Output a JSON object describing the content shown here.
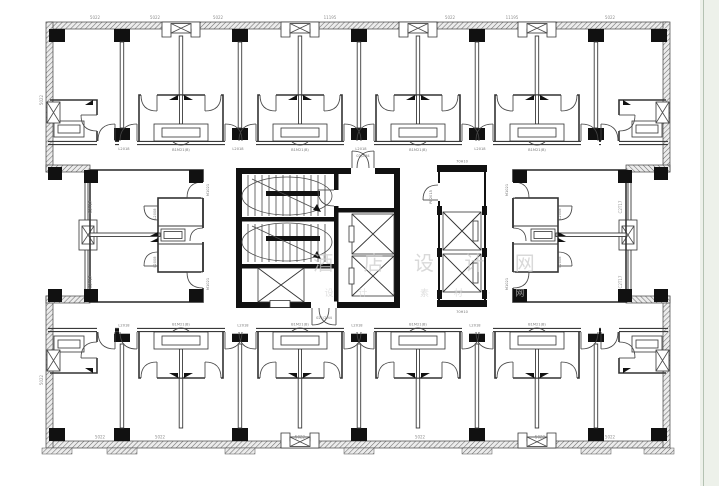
{
  "colors": {
    "background": "#ffffff",
    "wall_line": "#3a3a3a",
    "column_fill": "#111111",
    "dimension_text": "#8f8f8f",
    "tag_text": "#777777",
    "watermark_text": "#c9c9c9",
    "watermark_text2": "#d4d4d4",
    "side_panel_bg": "#edf1ea",
    "side_panel_line": "#b4c2b2"
  },
  "watermark": {
    "line1": "酒 店 设 计 网",
    "line2": "设 计 · 素 材 · 网"
  },
  "dims": {
    "top": [
      "5022",
      "5022",
      "5022",
      "11195",
      "5022",
      "11195",
      "5022"
    ],
    "bottom": [
      "5022",
      "5022",
      "5022",
      "5022",
      "5022",
      "5022"
    ],
    "left": [
      "5022",
      "5022"
    ],
    "inner_left": [
      "C2T17",
      "C2T17"
    ],
    "right": [
      "C2T17",
      "C2T17"
    ]
  },
  "tags": {
    "vanity": "B1M21(B)",
    "entry": "L2018",
    "pod_door": "L2008",
    "suite_entry": "M1021",
    "core_door_top": "02/2M4",
    "core_door_bottom": "021/2M4",
    "elev_door": "PB2015",
    "elev_bank_top": "70H10",
    "elev_bank_bottom": "70H10"
  }
}
